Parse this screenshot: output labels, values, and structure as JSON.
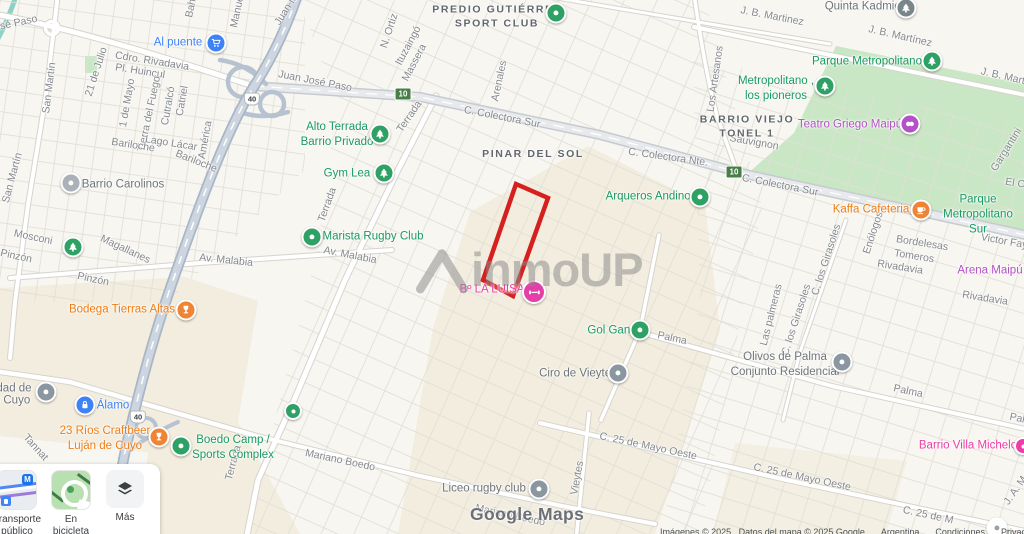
{
  "watermarks": {
    "brand": "inmoUP",
    "maps": "Google Maps"
  },
  "attribution": {
    "items": [
      {
        "t": "Imágenes © 2025 , Datos del mapa © 2025 Google",
        "link": false
      },
      {
        "t": "Argentina",
        "link": true
      },
      {
        "t": "Condiciones",
        "link": true
      },
      {
        "t": "Privacidad",
        "link": true
      },
      {
        "t": "Enviar co",
        "link": true
      }
    ]
  },
  "controls": {
    "transit_label": "Transporte público",
    "bike_label": "En bicicleta",
    "more_label": "Más"
  },
  "highlight": {
    "points": "516,184 548,198 513,296 483,280",
    "color": "#d61f1f"
  },
  "colors": {
    "poi_green": "#1a9a62",
    "poi_orange": "#ef7d17",
    "poi_blue": "#3f82f5",
    "poi_pink": "#ee3da8",
    "poi_purple": "#b351c6",
    "poi_gray": "#70757a",
    "street_label": "#85888d",
    "park_fill": "#c9e7c5",
    "commercial_fill": "#f2edde",
    "highway_fill": "#ccd5e0",
    "water": "#8ed1c6",
    "boundary_red": "#d61f1f"
  },
  "map": {
    "route_shields": [
      {
        "n": "10",
        "x": 403,
        "y": 94,
        "type": "green"
      },
      {
        "n": "10",
        "x": 734,
        "y": 172,
        "type": "green"
      },
      {
        "n": "40",
        "x": 252,
        "y": 99,
        "type": "white"
      },
      {
        "n": "40",
        "x": 138,
        "y": 417,
        "type": "white"
      }
    ],
    "labels": [
      {
        "t": "osé Paso",
        "x": 16,
        "y": 24,
        "k": "street",
        "r": -12
      },
      {
        "t": "Juan José Paso",
        "x": 315,
        "y": 82,
        "k": "street",
        "r": 11
      },
      {
        "t": "San Martín",
        "x": 50,
        "y": 88,
        "k": "street",
        "r": -83
      },
      {
        "t": "San Martín",
        "x": 13,
        "y": 178,
        "k": "street",
        "r": -75
      },
      {
        "t": "21 de Julio",
        "x": 97,
        "y": 72,
        "k": "street",
        "r": -72
      },
      {
        "t": "Cdro. Rivadavia",
        "x": 152,
        "y": 62,
        "k": "street",
        "r": 9
      },
      {
        "t": "Pl. Huincul",
        "x": 140,
        "y": 72,
        "k": "street",
        "r": 9
      },
      {
        "t": "1 de Mayo",
        "x": 128,
        "y": 103,
        "k": "street",
        "r": -80
      },
      {
        "t": "Tierra del Fuego",
        "x": 150,
        "y": 114,
        "k": "street",
        "r": -78
      },
      {
        "t": "Cutralcó",
        "x": 169,
        "y": 106,
        "k": "street",
        "r": -80
      },
      {
        "t": "Catriel",
        "x": 183,
        "y": 101,
        "k": "street",
        "r": -80
      },
      {
        "t": "Bariloche",
        "x": 133,
        "y": 146,
        "k": "street",
        "r": 9
      },
      {
        "t": "Lago Lácar",
        "x": 171,
        "y": 144,
        "k": "street",
        "r": 9
      },
      {
        "t": "América",
        "x": 206,
        "y": 140,
        "k": "street",
        "r": -80
      },
      {
        "t": "Bariloche",
        "x": 196,
        "y": 162,
        "k": "street",
        "r": 22
      },
      {
        "t": "Bahí",
        "x": 192,
        "y": 7,
        "k": "street",
        "r": -78
      },
      {
        "t": "Manue",
        "x": 238,
        "y": 12,
        "k": "street",
        "r": -78
      },
      {
        "t": "Juan M",
        "x": 287,
        "y": 10,
        "k": "street",
        "r": -58
      },
      {
        "t": "N. Ortiz",
        "x": 390,
        "y": 31,
        "k": "street",
        "r": -72
      },
      {
        "t": "Ituzaingó",
        "x": 409,
        "y": 46,
        "k": "street",
        "r": -62
      },
      {
        "t": "Massera",
        "x": 415,
        "y": 63,
        "k": "street",
        "r": -62
      },
      {
        "t": "Arenales",
        "x": 500,
        "y": 81,
        "k": "street",
        "r": -78
      },
      {
        "t": "Los Artesanos",
        "x": 716,
        "y": 79,
        "k": "street",
        "r": -82
      },
      {
        "t": "J. B. Martinez",
        "x": 772,
        "y": 17,
        "k": "street",
        "r": 11
      },
      {
        "t": "J. B. Martínez",
        "x": 900,
        "y": 37,
        "k": "street",
        "r": 13
      },
      {
        "t": "J. B. Martín",
        "x": 1007,
        "y": 78,
        "k": "street",
        "r": 13
      },
      {
        "t": "Sauvignon",
        "x": 754,
        "y": 143,
        "k": "street",
        "r": 10
      },
      {
        "t": "C. Colectora Sur",
        "x": 502,
        "y": 118,
        "k": "street",
        "r": 11
      },
      {
        "t": "C. Colectora Nte.",
        "x": 668,
        "y": 158,
        "k": "street",
        "r": 8
      },
      {
        "t": "C. Colectora Sur",
        "x": 780,
        "y": 186,
        "k": "street",
        "r": 11
      },
      {
        "t": "Terrada",
        "x": 410,
        "y": 117,
        "k": "street",
        "r": -55
      },
      {
        "t": "Terrada",
        "x": 328,
        "y": 205,
        "k": "street",
        "r": -70
      },
      {
        "t": "Terrada",
        "x": 234,
        "y": 463,
        "k": "street",
        "r": -75
      },
      {
        "t": "Av. Malabia",
        "x": 226,
        "y": 261,
        "k": "street",
        "r": 6
      },
      {
        "t": "Av. Malabia",
        "x": 350,
        "y": 256,
        "k": "street",
        "r": 11
      },
      {
        "t": "Mosconi",
        "x": 33,
        "y": 238,
        "k": "street",
        "r": 12
      },
      {
        "t": "Magallanes",
        "x": 125,
        "y": 250,
        "k": "street",
        "r": 25
      },
      {
        "t": "Pinzón",
        "x": 16,
        "y": 257,
        "k": "street",
        "r": 12
      },
      {
        "t": "Pinzón",
        "x": 93,
        "y": 280,
        "k": "street",
        "r": 12
      },
      {
        "t": "Tannat",
        "x": 35,
        "y": 448,
        "k": "street",
        "r": 48
      },
      {
        "t": "Mariano Boedo",
        "x": 340,
        "y": 461,
        "k": "street",
        "r": 12
      },
      {
        "t": "Mariano Boedo",
        "x": 510,
        "y": 516,
        "k": "street",
        "r": 12
      },
      {
        "t": "Vieytes",
        "x": 578,
        "y": 478,
        "k": "street",
        "r": -80
      },
      {
        "t": "C. 25 de Mayo Oeste",
        "x": 648,
        "y": 447,
        "k": "street",
        "r": 12
      },
      {
        "t": "C. 25 de Mayo Oeste",
        "x": 802,
        "y": 478,
        "k": "street",
        "r": 12
      },
      {
        "t": "C. 25 de M",
        "x": 928,
        "y": 516,
        "k": "street",
        "r": 12
      },
      {
        "t": "Palma",
        "x": 672,
        "y": 339,
        "k": "street",
        "r": 12
      },
      {
        "t": "Palma",
        "x": 908,
        "y": 392,
        "k": "street",
        "r": 12
      },
      {
        "t": "Pal",
        "x": 1017,
        "y": 419,
        "k": "street",
        "r": 12
      },
      {
        "t": "Las palmeras",
        "x": 772,
        "y": 315,
        "k": "street",
        "r": -76
      },
      {
        "t": "C. los Girasoles",
        "x": 797,
        "y": 320,
        "k": "street",
        "r": -72
      },
      {
        "t": "C. los Girasoles",
        "x": 827,
        "y": 260,
        "k": "street",
        "r": -72
      },
      {
        "t": "Enólogos",
        "x": 874,
        "y": 233,
        "k": "street",
        "r": -72
      },
      {
        "t": "Bordelesas",
        "x": 922,
        "y": 244,
        "k": "street",
        "r": 9
      },
      {
        "t": "Tomeros",
        "x": 914,
        "y": 257,
        "k": "street",
        "r": 9
      },
      {
        "t": "Rivadavia",
        "x": 900,
        "y": 268,
        "k": "street",
        "r": 9
      },
      {
        "t": "Rivadavia",
        "x": 985,
        "y": 299,
        "k": "street",
        "r": 9
      },
      {
        "t": "Victor Fay",
        "x": 1004,
        "y": 242,
        "k": "street",
        "r": 10
      },
      {
        "t": "El C",
        "x": 1015,
        "y": 184,
        "k": "street",
        "r": 9
      },
      {
        "t": "Gargantini",
        "x": 1007,
        "y": 150,
        "k": "street",
        "r": -58
      },
      {
        "t": "J. A. M",
        "x": 1016,
        "y": 491,
        "k": "street",
        "r": -55
      },
      {
        "lines": [
          "PREDIO GUTIÉRREZ",
          "SPORT CLUB"
        ],
        "x": 497,
        "y": 17,
        "k": "area"
      },
      {
        "t": "PINAR DEL SOL",
        "x": 533,
        "y": 155,
        "k": "area"
      },
      {
        "lines": [
          "BARRIO VIEJO",
          "TONEL 1"
        ],
        "x": 747,
        "y": 127,
        "k": "area"
      },
      {
        "lines": [
          "Alto Terrada",
          "Barrio Privado"
        ],
        "x": 337,
        "y": 135,
        "k": "poi-green"
      },
      {
        "t": "Gym Lea",
        "x": 347,
        "y": 174,
        "k": "poi-green"
      },
      {
        "t": "Marista Rugby Club",
        "x": 373,
        "y": 237,
        "k": "poi-green"
      },
      {
        "t": "Arqueros Andinos",
        "x": 651,
        "y": 197,
        "k": "poi-green"
      },
      {
        "t": "Parque Metropolitano",
        "x": 867,
        "y": 62,
        "k": "poi-green"
      },
      {
        "lines": [
          "Metropolitano ,",
          "los pioneros"
        ],
        "x": 776,
        "y": 89,
        "k": "poi-green"
      },
      {
        "lines": [
          "Parque",
          "Metropolitano",
          "Sur"
        ],
        "x": 978,
        "y": 215,
        "k": "poi-green"
      },
      {
        "t": "Gol Gana",
        "x": 612,
        "y": 331,
        "k": "poi-green"
      },
      {
        "lines": [
          "Boedo Camp /",
          "Sports Complex"
        ],
        "x": 233,
        "y": 448,
        "k": "poi-green"
      },
      {
        "t": "Barrio Carolinos",
        "x": 123,
        "y": 185,
        "k": "poi-gray"
      },
      {
        "t": "Quinta Kadmiel",
        "x": 864,
        "y": 7,
        "k": "poi-gray"
      },
      {
        "t": "Ciro de Vieytes",
        "x": 578,
        "y": 374,
        "k": "poi-gray"
      },
      {
        "lines": [
          "Olivos de Palma",
          "Conjunto Residencial"
        ],
        "x": 785,
        "y": 365,
        "k": "poi-gray"
      },
      {
        "t": "Liceo rugby club",
        "x": 484,
        "y": 489,
        "k": "poi-gray"
      },
      {
        "t": "dad de",
        "x": 14,
        "y": 389,
        "k": "poi-gray"
      },
      {
        "t": "e Cuyo",
        "x": 12,
        "y": 401,
        "k": "poi-gray"
      },
      {
        "t": "Bodega Tierras Altas",
        "x": 122,
        "y": 310,
        "k": "poi-orange"
      },
      {
        "t": "Kaffa Cafeteria",
        "x": 871,
        "y": 210,
        "k": "poi-orange"
      },
      {
        "lines": [
          "23 Ríos Craftbeer",
          "Luján de Cuyo"
        ],
        "x": 105,
        "y": 439,
        "k": "poi-orange"
      },
      {
        "t": "Al puente",
        "x": 178,
        "y": 43,
        "k": "poi-blue"
      },
      {
        "t": "Álamo",
        "x": 113,
        "y": 406,
        "k": "poi-blue"
      },
      {
        "t": "Bº LA LUISA",
        "x": 492,
        "y": 290,
        "k": "poi-pink"
      },
      {
        "t": "Barrio Villa Michelo",
        "x": 968,
        "y": 446,
        "k": "poi-pink"
      },
      {
        "t": "Teatro Griego Maipú",
        "x": 850,
        "y": 125,
        "k": "poi-purple"
      },
      {
        "t": "Arena Maipú",
        "x": 990,
        "y": 271,
        "k": "poi-purple"
      }
    ],
    "markers": [
      {
        "x": 216,
        "y": 43,
        "c": "#3f82f5",
        "i": "cart-icon"
      },
      {
        "x": 556,
        "y": 13,
        "c": "#2fa164",
        "i": "dot-icon"
      },
      {
        "x": 906,
        "y": 8,
        "c": "#79878b",
        "i": "tree-icon"
      },
      {
        "x": 932,
        "y": 61,
        "c": "#2fa164",
        "i": "tree-icon"
      },
      {
        "x": 825,
        "y": 86,
        "c": "#2fa164",
        "i": "tree-icon"
      },
      {
        "x": 910,
        "y": 124,
        "c": "#b351c6",
        "i": "theater-icon"
      },
      {
        "x": 380,
        "y": 134,
        "c": "#2fa164",
        "i": "tree-icon"
      },
      {
        "x": 384,
        "y": 173,
        "c": "#2fa164",
        "i": "tree-icon"
      },
      {
        "x": 312,
        "y": 237,
        "c": "#2fa164",
        "i": "dot-icon"
      },
      {
        "x": 700,
        "y": 197,
        "c": "#2fa164",
        "i": "dot-icon"
      },
      {
        "x": 71,
        "y": 183,
        "c": "#a9b2b9",
        "i": "dot-icon"
      },
      {
        "x": 73,
        "y": 247,
        "c": "#2fa164",
        "i": "tree-icon"
      },
      {
        "x": 186,
        "y": 310,
        "c": "#ef8434",
        "i": "wine-icon"
      },
      {
        "x": 921,
        "y": 210,
        "c": "#ef8434",
        "i": "cup-icon"
      },
      {
        "x": 534,
        "y": 292,
        "c": "#e43fa8",
        "i": "gym-icon",
        "s": 20
      },
      {
        "x": 640,
        "y": 330,
        "c": "#2fa164",
        "i": "dot-icon"
      },
      {
        "x": 618,
        "y": 373,
        "c": "#8a97a0",
        "i": "dot-icon"
      },
      {
        "x": 842,
        "y": 362,
        "c": "#8a97a0",
        "i": "dot-icon"
      },
      {
        "x": 46,
        "y": 392,
        "c": "#8a97a0",
        "i": "dot-icon"
      },
      {
        "x": 85,
        "y": 405,
        "c": "#3f82f5",
        "i": "lock-icon"
      },
      {
        "x": 159,
        "y": 437,
        "c": "#ef8434",
        "i": "wine-icon"
      },
      {
        "x": 181,
        "y": 446,
        "c": "#2fa164",
        "i": "dot-icon"
      },
      {
        "x": 293,
        "y": 411,
        "c": "#2fa164",
        "i": "dot-icon",
        "s": 14
      },
      {
        "x": 539,
        "y": 489,
        "c": "#8a97a0",
        "i": "dot-icon"
      },
      {
        "x": 997,
        "y": 528,
        "c": "#ffffff",
        "i": "place-icon"
      },
      {
        "x": 1023,
        "y": 446,
        "c": "#ee3da8",
        "i": "dot-icon",
        "s": 14
      }
    ]
  }
}
